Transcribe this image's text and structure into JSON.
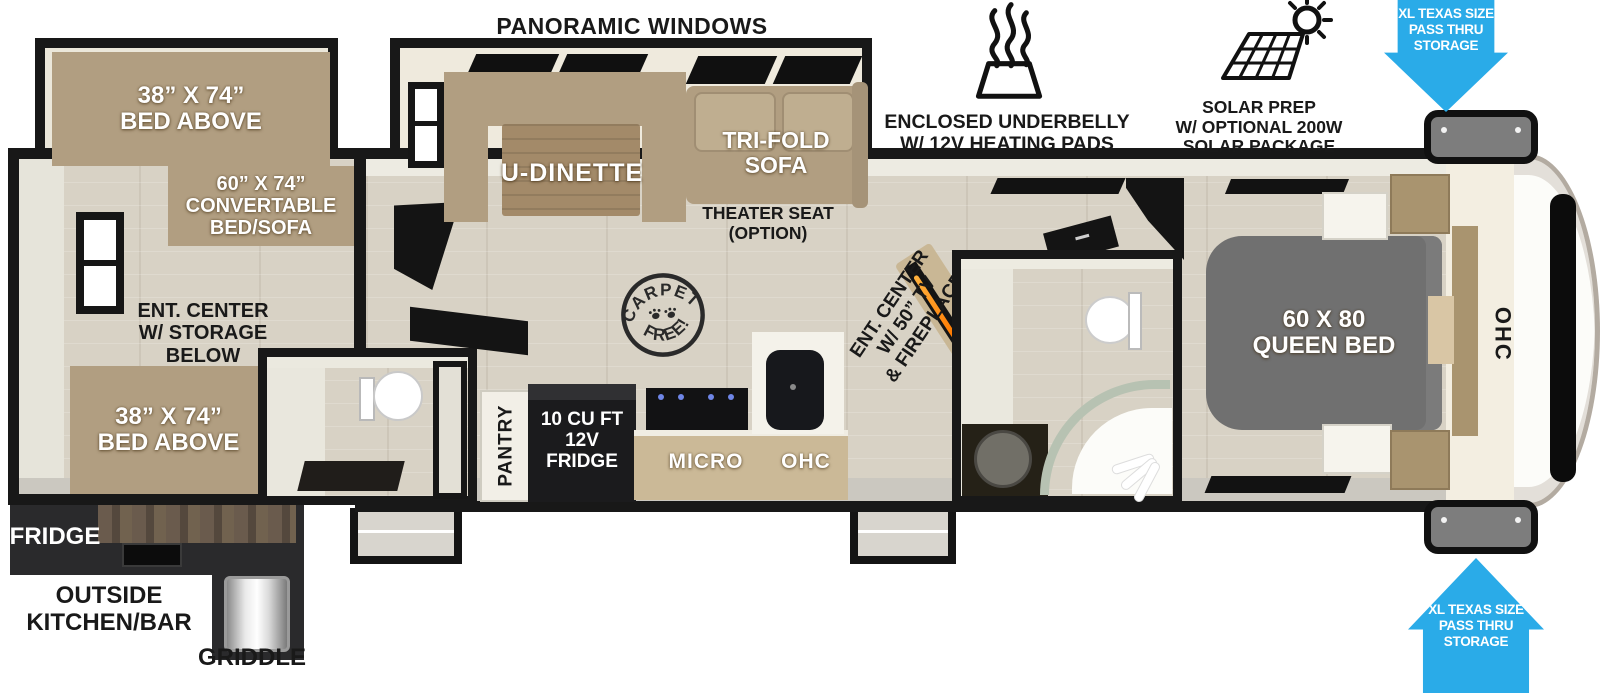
{
  "colors": {
    "accent_blue": "#2aabe8",
    "furniture_tan": "#b19e81",
    "bed_gray": "#707070",
    "wall_black": "#181818",
    "floor_wood": "#d8d2c5"
  },
  "callouts": {
    "panoramic_windows": "PANORAMIC WINDOWS",
    "underbelly_line1": "ENCLOSED UNDERBELLY",
    "underbelly_line2": "W/ 12V HEATING PADS",
    "solar_line1": "SOLAR PREP",
    "solar_line2": "W/ OPTIONAL 200W",
    "solar_line3": "SOLAR PACKAGE",
    "pass_thru_line1": "XL TEXAS SIZE",
    "pass_thru_line2": "PASS THRU",
    "pass_thru_line3": "STORAGE"
  },
  "rear": {
    "bunk_top_line1": "38” X 74”",
    "bunk_top_line2": "BED ABOVE",
    "convertible_line1": "60” X 74”",
    "convertible_line2": "CONVERTABLE",
    "convertible_line3": "BED/SOFA",
    "ent_center_line1": "ENT. CENTER",
    "ent_center_line2": "W/ STORAGE",
    "ent_center_line3": "BELOW",
    "bunk_bottom_line1": "38” X 74”",
    "bunk_bottom_line2": "BED ABOVE"
  },
  "outside_kitchen": {
    "fridge": "FRIDGE",
    "name_line1": "OUTSIDE",
    "name_line2": "KITCHEN/BAR",
    "griddle": "GRIDDLE"
  },
  "living": {
    "dinette": "U-DINETTE",
    "sofa_line1": "TRI-FOLD",
    "sofa_line2": "SOFA",
    "theater_line1": "THEATER SEAT",
    "theater_line2": "(OPTION)",
    "stamp_top": "CARPET",
    "stamp_bottom": "FREE!",
    "ent_center_line1": "ENT. CENTER",
    "ent_center_line2": "W/ 50” TV",
    "ent_center_line3": "& FIREPLACE"
  },
  "kitchen": {
    "pantry": "PANTRY",
    "fridge_line1": "10 CU FT",
    "fridge_line2": "12V",
    "fridge_line3": "FRIDGE",
    "micro": "MICRO",
    "ohc": "OHC"
  },
  "bedroom": {
    "bed_line1": "60 X 80",
    "bed_line2": "QUEEN BED",
    "ohc": "OHC"
  }
}
